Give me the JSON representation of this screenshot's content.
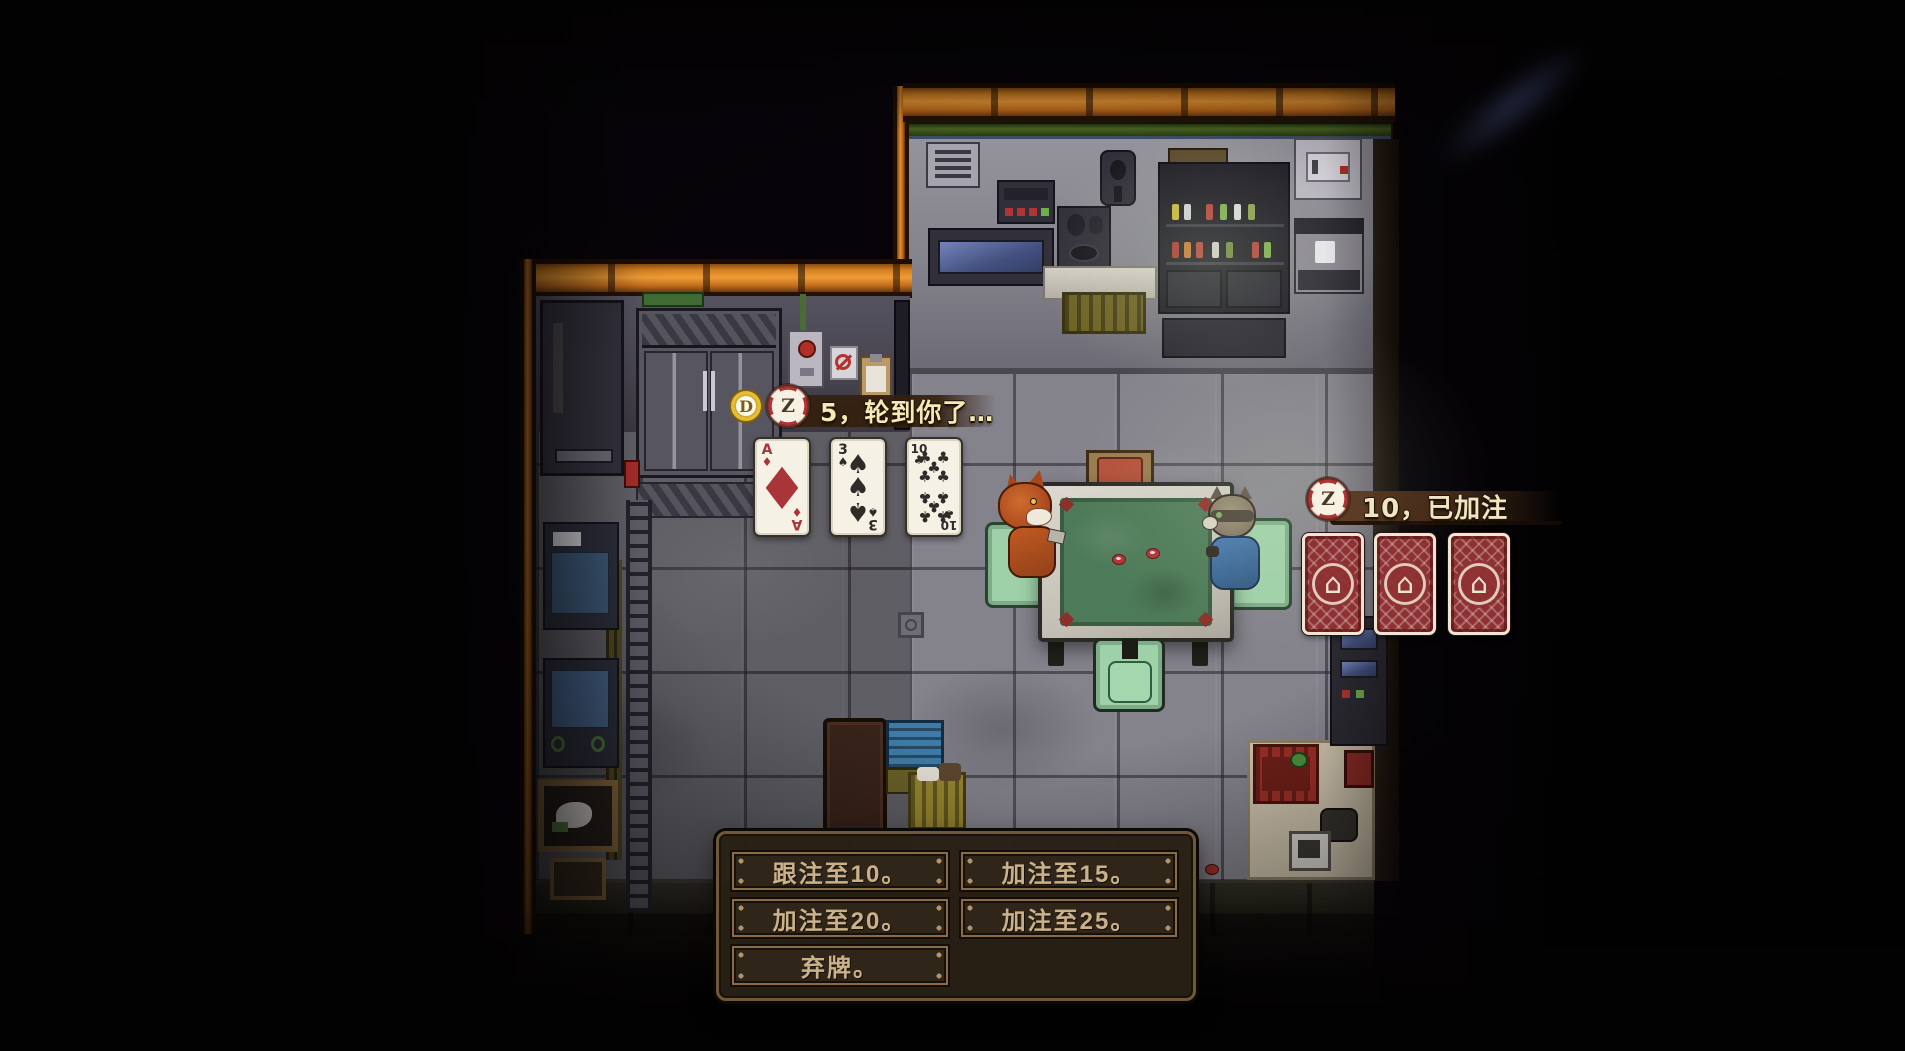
{
  "hud": {
    "turn_indicator": {
      "coin_label": "D",
      "chip_label": "Z",
      "text": "5，轮到你了…"
    },
    "bet_indicator": {
      "chip_label": "Z",
      "text": "10，已加注"
    },
    "hand_cards": [
      {
        "rank": "A",
        "suit": "♦",
        "suit_name": "diamonds",
        "color": "#a93538"
      },
      {
        "rank": "3",
        "suit": "♠",
        "suit_name": "spades",
        "color": "#2e2b29"
      },
      {
        "rank": "10",
        "suit": "♣",
        "suit_name": "clubs",
        "color": "#2e2b29"
      }
    ],
    "opponent_cards": {
      "count": 3,
      "emblem": "⌂"
    },
    "actions": {
      "call": "跟注至10。",
      "raise_15": "加注至15。",
      "raise_20": "加注至20。",
      "raise_25": "加注至25。",
      "fold": "弃牌。"
    }
  },
  "scene": {
    "players": [
      {
        "id": "fox",
        "side": "left"
      },
      {
        "id": "raccoon",
        "side": "right"
      }
    ],
    "chips_on_table": 2
  },
  "palette": {
    "wall_trim_orange": "#ef9c38",
    "floor_gray": "#84828b",
    "felt_green": "#4d7a58",
    "card_back_red": "#8e3134",
    "panel_brown": "#281f15",
    "button_border": "#8a6b46",
    "button_text": "#cbb189",
    "hud_text": "#f3eab6",
    "chip_red": "#b23335",
    "coin_gold": "#e6bd33"
  }
}
